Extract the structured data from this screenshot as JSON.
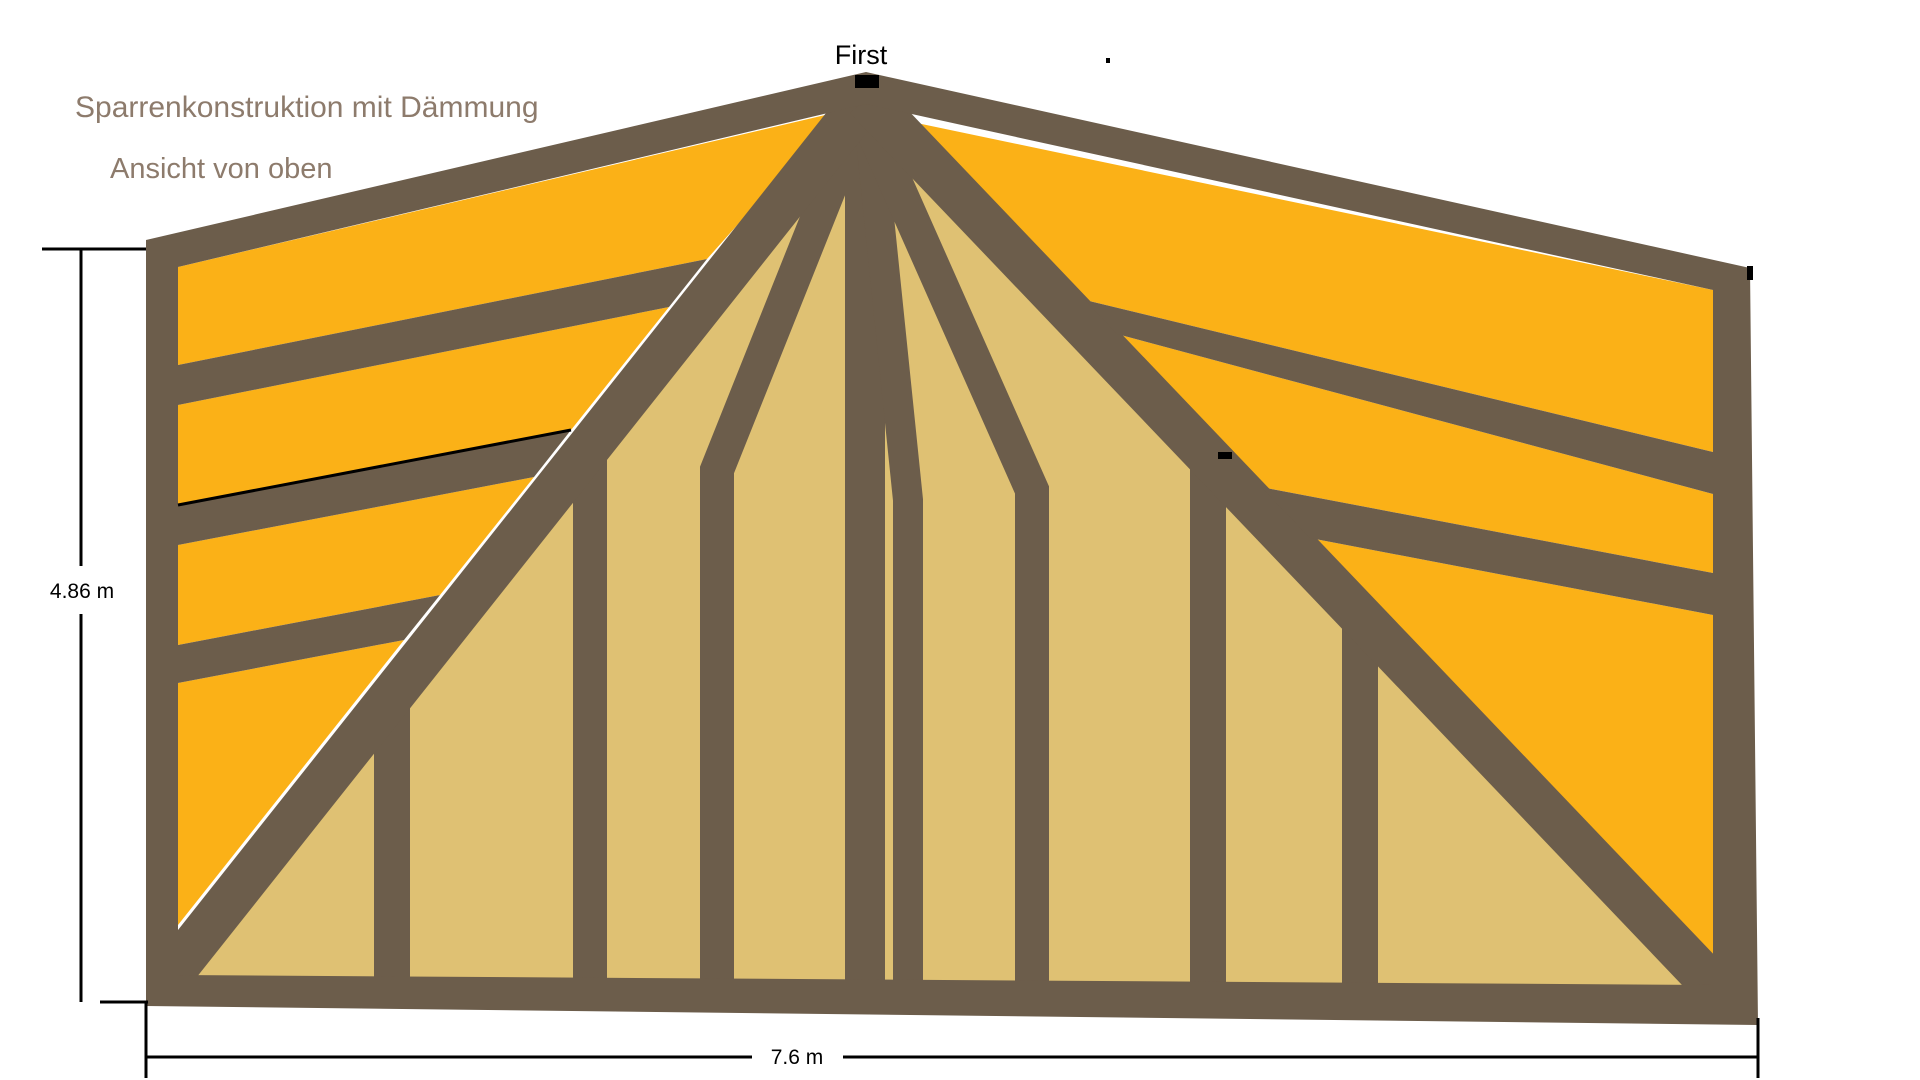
{
  "title": "Sparrenkonstruktion mit Dämmung",
  "subtitle": "Ansicht von oben",
  "ridge": {
    "label": "First"
  },
  "dimensions": {
    "height_label": "4.86 m",
    "width_label": "7.6 m"
  },
  "colors": {
    "background": "#FFFFFF",
    "beam": "#6C5D4B",
    "insulation": "#FBB117",
    "panel": "#DFC173",
    "label_muted": "#8D7B6C",
    "detail": "#000000"
  }
}
